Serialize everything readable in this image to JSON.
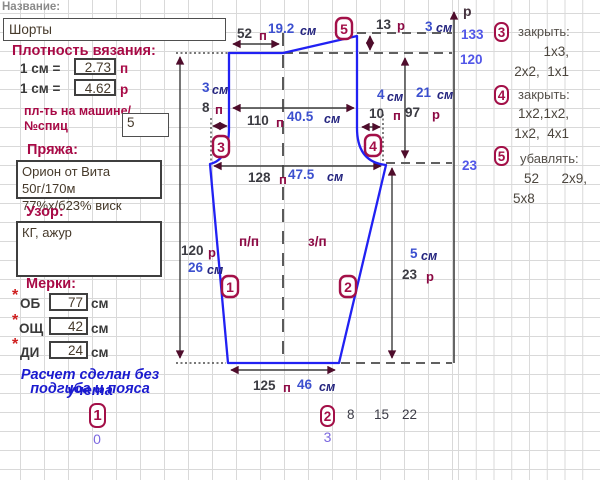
{
  "header": {
    "name_label": "Название:",
    "name_value": "Шорты"
  },
  "density": {
    "title": "Плотность вязания:",
    "row1_label": "1 см =",
    "row1_value": "2.73",
    "row1_unit": "п",
    "row2_label": "1 см =",
    "row2_value": "4.62",
    "row2_unit": "р",
    "machine_label_1": "пл-ть на машине/",
    "machine_label_2": "№спиц",
    "machine_value": "5"
  },
  "yarn": {
    "title": "Пряжа:",
    "line1": "Орион от Вита 50г/170м",
    "line2": "77%х/б23% виск"
  },
  "pattern": {
    "title": "Узор:",
    "value": "КГ, ажур"
  },
  "measurements": {
    "title": "Мерки:",
    "star": "*",
    "rows": [
      {
        "label": "ОБ",
        "value": "77",
        "unit": "см"
      },
      {
        "label": "ОЩ",
        "value": "42",
        "unit": "см"
      },
      {
        "label": "ДИ",
        "value": "24",
        "unit": "см"
      }
    ]
  },
  "note": {
    "line1": "Расчет сделан без учета",
    "line2": "подгиба и пояса"
  },
  "footer": {
    "left_marker": {
      "num": "1",
      "sub": "0"
    },
    "mid_marker": {
      "num": "2",
      "sub": "3"
    },
    "row_numbers": [
      "8",
      "15",
      "22"
    ]
  },
  "diagram": {
    "circles": {
      "c1": "1",
      "c2": "2",
      "c3": "3",
      "c4": "4",
      "c5": "5"
    },
    "top_w": {
      "n": "52",
      "u": "п"
    },
    "top_w_cm": {
      "n": "19.2",
      "u": "см"
    },
    "rise": {
      "n": "13",
      "u": "р"
    },
    "rise_cm": {
      "n": "3",
      "u": "см"
    },
    "hip": {
      "n": "110",
      "u": "п"
    },
    "hip_cm": {
      "n": "40.5",
      "u": "см"
    },
    "l_ext_cm": {
      "n": "3",
      "u": "см"
    },
    "l_ext": {
      "n": "8",
      "u": "п"
    },
    "r_ext_cm": {
      "n": "4",
      "u": "см"
    },
    "r_ext": {
      "n": "10",
      "u": "п"
    },
    "upper_cm": {
      "n": "21",
      "u": "см"
    },
    "upper": {
      "n": "97",
      "u": "р"
    },
    "seat": {
      "n": "128",
      "u": "п"
    },
    "seat_cm": {
      "n": "47.5",
      "u": "см"
    },
    "len": {
      "n": "120",
      "u": "р"
    },
    "len_cm": {
      "n": "26",
      "u": "см"
    },
    "lower_cm": {
      "n": "5",
      "u": "см"
    },
    "lower": {
      "n": "23",
      "u": "р"
    },
    "hem": {
      "n": "125",
      "u": "п"
    },
    "hem_cm": {
      "n": "46",
      "u": "см"
    },
    "front_label": "п/п",
    "back_label": "з/п",
    "axis_label": "р",
    "ticks": [
      "133",
      "120",
      "23"
    ]
  },
  "instructions": [
    {
      "num": "3",
      "title": "закрыть:",
      "lines": [
        "1х3,",
        "2х2,  1х1"
      ]
    },
    {
      "num": "4",
      "title": "закрыть:",
      "lines": [
        "1х2,1х2,",
        "1х2,  4х1"
      ]
    },
    {
      "num": "5",
      "title": "убавлять:",
      "lines": [
        "52      2х9,",
        "5х8"
      ]
    }
  ],
  "colors": {
    "accent": "#a80a46",
    "line_blue": "#2121f3",
    "axis_blue": "#5156e8"
  }
}
